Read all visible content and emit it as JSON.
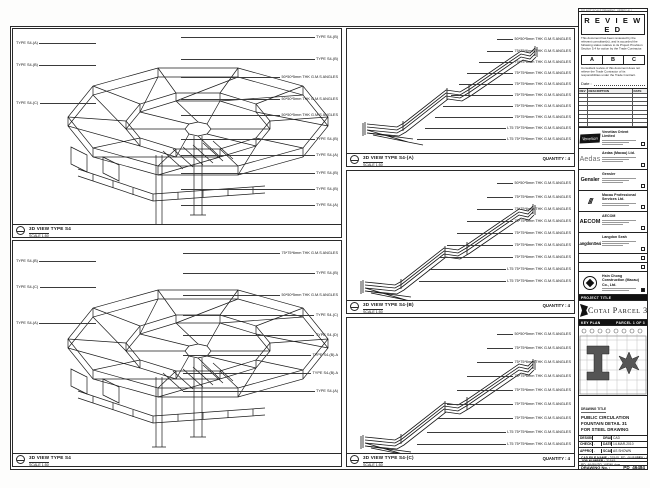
{
  "panels": {
    "p1": {
      "title": "3D VIEW TYPE S4",
      "scale": "SCALE 1:50",
      "labels_right": [
        "TYPE S4-(B)",
        "TYPE S4-(B)",
        "50*50*5mm THK G.M.S ANGLES",
        "50*50*5mm THK G.M.S ANGLES",
        "50*50*5mm THK G.M.S ANGLES",
        "TYPE S4-(B)",
        "TYPE S4-(A)",
        "TYPE S4-(B)",
        "TYPE S4-(B)",
        "TYPE S4-(A)"
      ],
      "labels_left": [
        "TYPE S4-(A)",
        "TYPE S4-(B)",
        "TYPE S4-(C)"
      ]
    },
    "p2": {
      "title": "3D VIEW TYPE S4",
      "scale": "SCALE 1:50",
      "labels_right": [
        "75*75*6mm THK G.M.S ANGLES",
        "TYPE S4-(B)",
        "50*50*5mm THK G.M.S ANGLES",
        "TYPE S4-(C)",
        "TYPE S4-(D)",
        "TYPE S4-(B).A",
        "TYPE S4-(B).A",
        "TYPE S4-(A)"
      ],
      "labels_left": [
        "TYPE S4-(B)",
        "TYPE S4-(C)",
        "TYPE S4-(A)"
      ]
    },
    "p3": {
      "title": "3D VIEW TYPE S4-(A)",
      "quantity": "QUANTITY : 4",
      "scale": "SCALE 1:50",
      "labels": [
        "50*50*5mm THK G.M.S ANGLES",
        "75*75*6mm THK G.M.S ANGLES",
        "75*75*6mm THK G.M.S ANGLES",
        "75*75*6mm THK G.M.S ANGLES",
        "75*75*6mm THK G.M.S ANGLES",
        "75*75*6mm THK G.M.S ANGLES",
        "75*75*6mm THK G.M.S ANGLES",
        "75*75*6mm THK G.M.S ANGLES",
        "L75 75*75*6mm THK G.M.S ANGLES",
        "L75 75*75*6mm THK G.M.S ANGLES"
      ]
    },
    "p4": {
      "title": "3D VIEW TYPE S4-(B)",
      "quantity": "QUANTITY : 4",
      "scale": "SCALE 1:50",
      "labels": [
        "50*50*5mm THK G.M.S ANGLES",
        "75*75*6mm THK G.M.S ANGLES",
        "75*75*6mm THK G.M.S ANGLES",
        "75*75*6mm THK G.M.S ANGLES",
        "75*75*6mm THK G.M.S ANGLES",
        "75*75*6mm THK G.M.S ANGLES",
        "75*75*6mm THK G.M.S ANGLES",
        "L75 75*75*6mm THK G.M.S ANGLES",
        "L75 75*75*6mm THK G.M.S ANGLES"
      ]
    },
    "p5": {
      "title": "3D VIEW TYPE S4-(C)",
      "quantity": "QUANTITY : 4",
      "scale": "SCALE 1:50",
      "labels": [
        "50*50*5mm THK G.M.S ANGLES",
        "75*75*6mm THK G.M.S ANGLES",
        "75*75*6mm THK G.M.S ANGLES",
        "75*75*6mm THK G.M.S ANGLES",
        "75*75*6mm THK G.M.S ANGLES",
        "75*75*6mm THK G.M.S ANGLES",
        "75*75*6mm THK G.M.S ANGLES",
        "L75 75*75*6mm THK G.M.S ANGLES",
        "L75 75*75*6mm THK G.M.S ANGLES"
      ]
    }
  },
  "titleblock": {
    "disclaimer": "DO NOT SCALE DRAWING. VERIFY ALL DIMENSIONS ON SITE.",
    "reviewed": {
      "title": "R E V I E W E D",
      "para1": "This document has been reviewed by the relevant consultant(s), and is accorded the following status relative to its Project Provision Section 5.4 for action by the Trade Contractor.",
      "options": [
        "A",
        "B",
        "C"
      ],
      "para2": "Consultant review of this document does not relieve the Trade Contractor of its responsibilities under the Trade Contract.",
      "date_label": "Date :"
    },
    "revisions": {
      "headers": [
        "REV",
        "DESCRIPTION",
        "DATE"
      ]
    },
    "consultants": [
      {
        "logo": "Venetian",
        "name": "Venetian Orient Limited"
      },
      {
        "logo": "Aedas",
        "name": "Aedas (Macau) Ltd."
      },
      {
        "logo": "Gensler",
        "name": "Gensler"
      },
      {
        "logo": "///",
        "name": "Macau Professional Services Ltd."
      },
      {
        "logo": "AECOM",
        "name": "AECOM"
      },
      {
        "logo": "LangdonSeah",
        "name": "Langdon Seah"
      },
      {
        "logo": "",
        "name": ""
      },
      {
        "logo": "",
        "name": ""
      },
      {
        "logo": "",
        "name": "Hsin Chong Construction (Macau) Co., Ltd."
      }
    ],
    "project": {
      "label": "PROJECT TITLE",
      "name": "Cotai Parcel 3"
    },
    "keyplan": {
      "label": "KEY PLAN",
      "ref": "PARCEL 1 OF 3"
    },
    "drawing_title": {
      "label": "DRAWING TITLE",
      "line1": "PUBLIC CIRCULATION",
      "line2": "FOUNTAIN DETAIL 31",
      "line3": "FOR STEEL DRAWING"
    },
    "signoff": {
      "designed_label": "DESIGNED",
      "designed": "",
      "drawn_label": "DRAWN",
      "drawn": "CAD",
      "checked_label": "CHECKED",
      "checked": "-",
      "date_label": "DATE",
      "date": "14-MAR-2010",
      "approved_label": "APPROVED",
      "approved": "-",
      "scale_label": "SCALE",
      "scale": "AS SHOWN"
    },
    "file": {
      "cad_label": "CAD FILE NAME :",
      "cad": "31545_PD_46484",
      "rev_label": "REV :",
      "rev": "A",
      "job_label": "JOB NUMBER :",
      "job": "31545",
      "ref": "PD_46484(3D_VIEW).dwg",
      "dwg_label": "DRAWING No. :",
      "dwg": "PD_46484"
    }
  }
}
